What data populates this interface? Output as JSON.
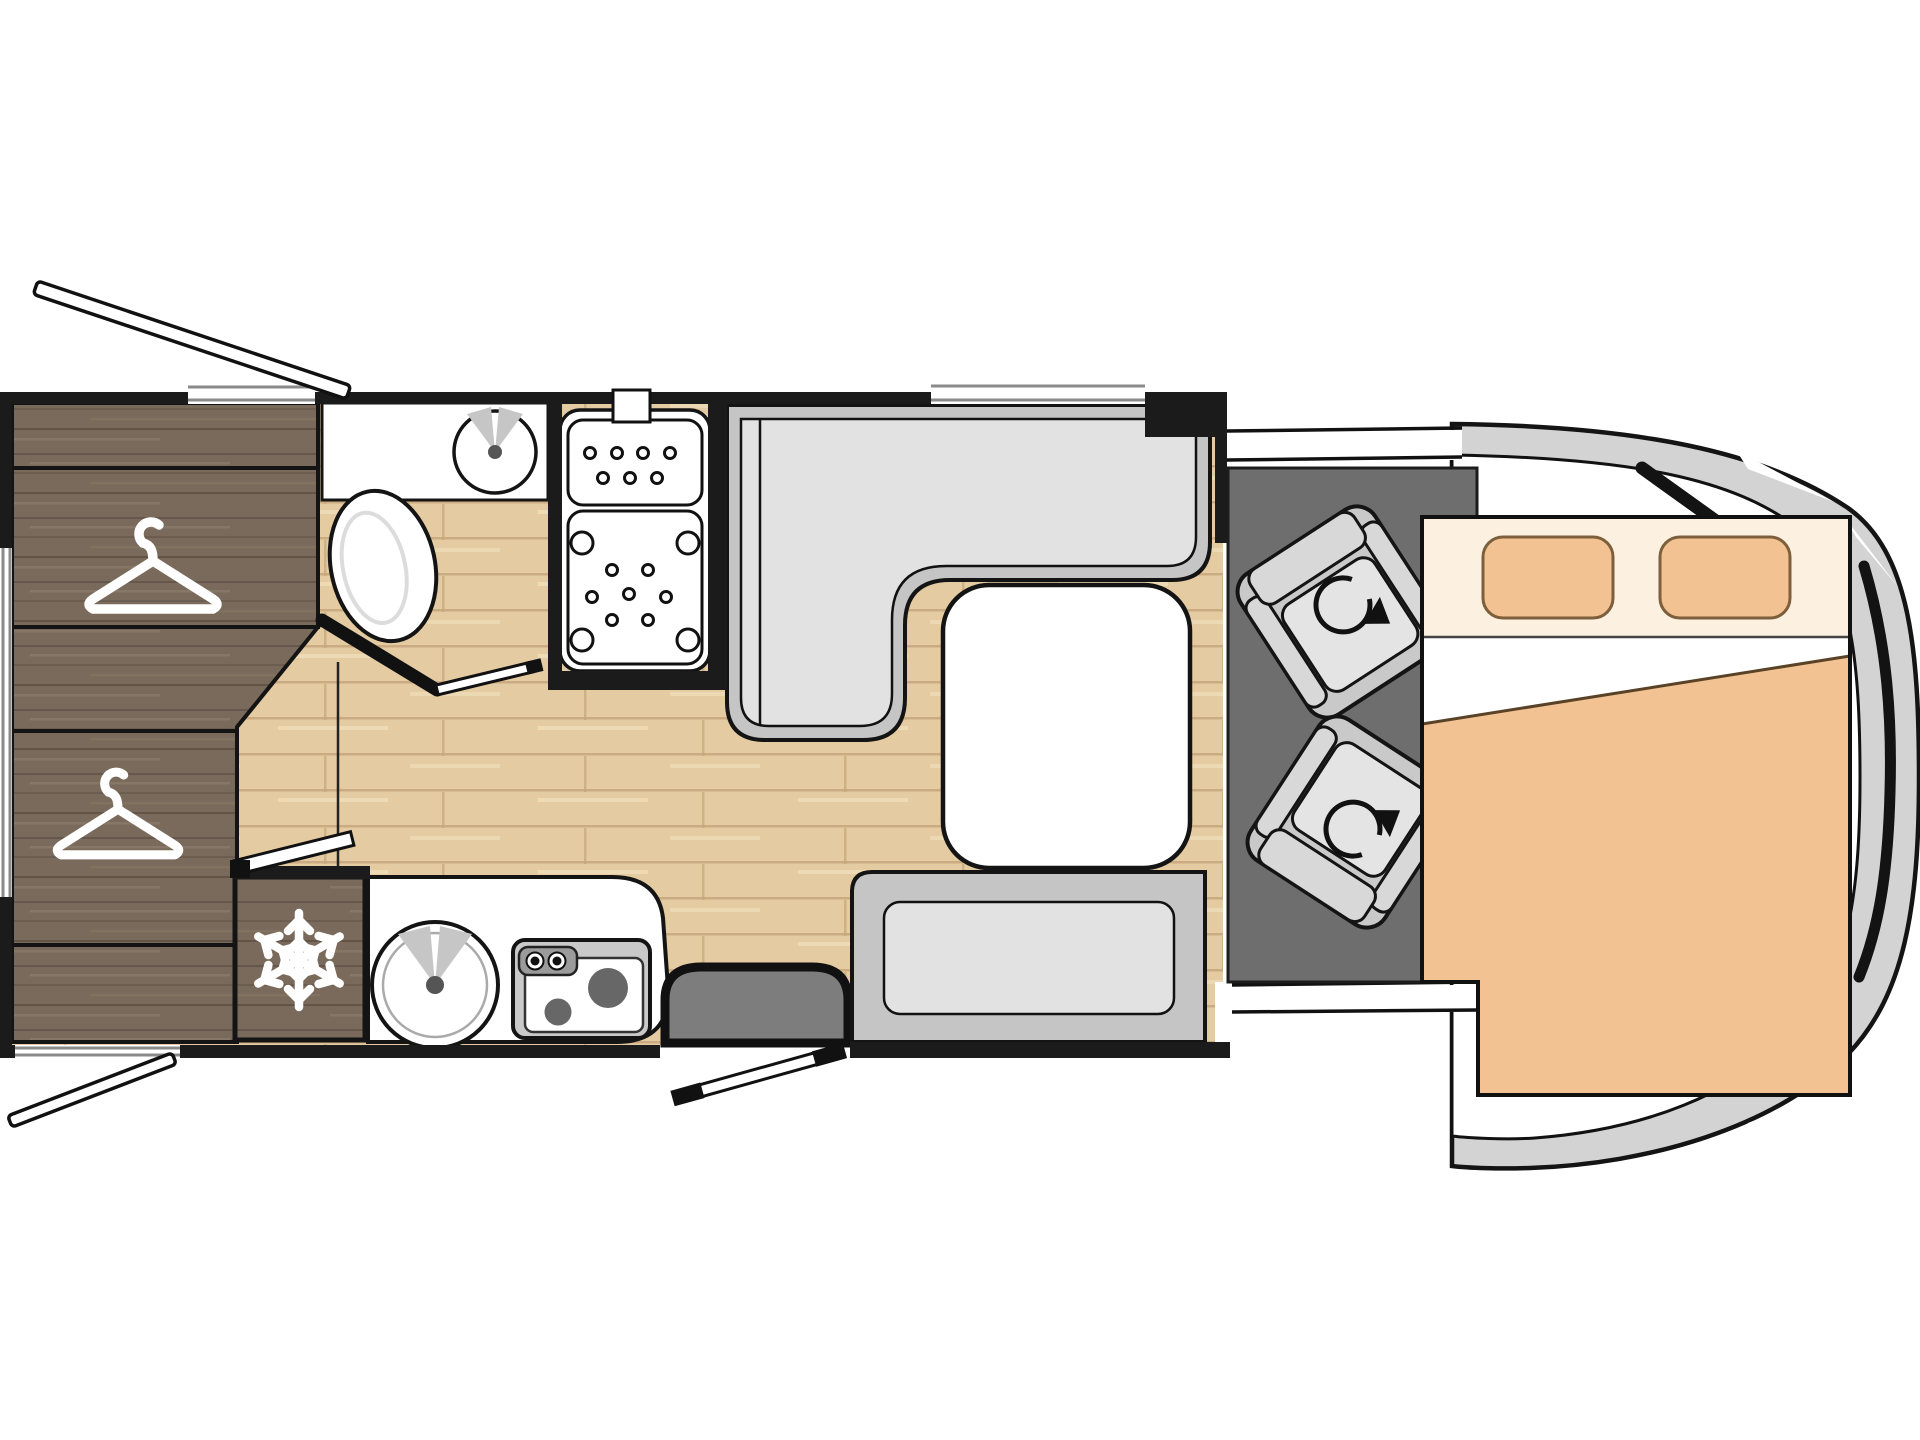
{
  "meta": {
    "kind": "motorhome-floorplan",
    "view": "top-down",
    "orientation": "cab-at-right",
    "visible_text": []
  },
  "colors": {
    "white": "#ffffff",
    "wall": "#1b1b1b",
    "outline": "#141414",
    "floor": "#e4cba2",
    "floor_seam": "#c7a67b",
    "floor_light": "#f0ddba",
    "wood": "#796a5c",
    "wood_grain_dark": "#63564a",
    "wood_grain_light": "#8b7b6a",
    "bench": "#c5c5c5",
    "cushion": "#e2e2e2",
    "cab_floor": "#6e6e6e",
    "step": "#7d7d7d",
    "body": "#d3d3d3",
    "seat": "#c9c9c9",
    "seat_trim": "#d8d8d8",
    "seat_cushion": "#e4e4e4",
    "bed_head": "#fcf0e1",
    "pillow": "#f3c292",
    "pillow_stroke": "#7d5f3c",
    "blanket": "#f3c292",
    "basin_fan": "#c6c6c6",
    "basin_dot": "#555555",
    "burner": "#676767",
    "knob_strip": "#9b9b9b",
    "window_frame": "#8a8a8a"
  },
  "plan": {
    "zones": [
      {
        "name": "rear-bedroom",
        "items": [
          "wardrobe-upper",
          "wardrobe-lower",
          "drawer-unit",
          "hanger-icon",
          "hanger-icon"
        ]
      },
      {
        "name": "bathroom",
        "items": [
          "washbasin",
          "toilet",
          "bathroom-door"
        ]
      },
      {
        "name": "shower",
        "items": [
          "shower-tray",
          "drain-dots"
        ]
      },
      {
        "name": "kitchen",
        "items": [
          "fridge",
          "snowflake-icon",
          "kitchen-sink",
          "hob-two-burners",
          "counter"
        ]
      },
      {
        "name": "dinette",
        "items": [
          "l-shaped-bench",
          "table",
          "side-bench"
        ]
      },
      {
        "name": "entrance",
        "items": [
          "entry-step",
          "entry-door-open"
        ]
      },
      {
        "name": "cab",
        "items": [
          "swivel-seat",
          "swivel-seat",
          "rotation-arrow-icon",
          "rotation-arrow-icon",
          "windshield",
          "cab-body"
        ]
      },
      {
        "name": "drop-down-bed",
        "items": [
          "pillow",
          "pillow",
          "sheet",
          "blanket"
        ]
      }
    ],
    "counts": {
      "hangers": 2,
      "swivel_seats": 2,
      "pillows": 2,
      "burners": 2,
      "stove_knobs": 2,
      "windows": 4,
      "exterior_hatches": 2,
      "doors": 4
    }
  }
}
